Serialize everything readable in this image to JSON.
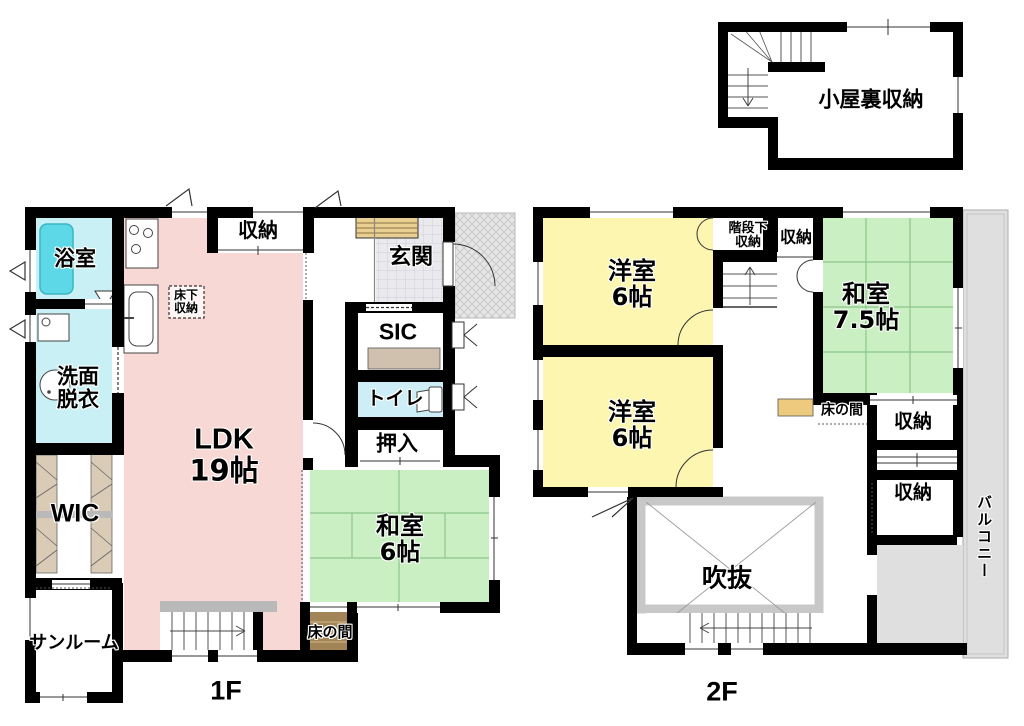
{
  "floor1": {
    "name": "1F",
    "rooms": {
      "bath": "浴室",
      "washroom_line1": "洗面",
      "washroom_line2": "脱衣",
      "wic": "WIC",
      "sunroom": "サンルーム",
      "ldk_line1": "LDK",
      "ldk_line2": "19帖",
      "storage_top": "収納",
      "underfloor_line1": "床下",
      "underfloor_line2": "収納",
      "genkan": "玄関",
      "sic": "SIC",
      "toilet": "トイレ",
      "oshiire": "押入",
      "washitsu_line1": "和室",
      "washitsu_line2": "6帖",
      "tokonoma": "床の間"
    }
  },
  "floor2": {
    "name": "2F",
    "rooms": {
      "yoshitsu1_line1": "洋室",
      "yoshitsu1_line2": "6帖",
      "yoshitsu2_line1": "洋室",
      "yoshitsu2_line2": "6帖",
      "under_stair_line1": "階段下",
      "under_stair_line2": "収納",
      "storage_a": "収納",
      "washitsu_line1": "和室",
      "washitsu_line2": "7.5帖",
      "tokonoma": "床の間",
      "storage_b": "収納",
      "storage_c": "収納",
      "void": "吹抜",
      "balcony": "バルコニー"
    }
  },
  "attic": {
    "storage": "小屋裏収納"
  },
  "colors": {
    "wall": "#000000",
    "ldk_pink": "#f8d8d5",
    "western_room_yellow": "#fcf6b0",
    "tatami_green": "#c9efc2",
    "tatami_line": "#8fc58b",
    "bath_cyan": "#c9f1f5",
    "tub_cyan": "#5cd8e6",
    "toilet_blue": "#cdeef7",
    "genkan_tile": "#eaeaee",
    "porch_gray": "#e6e6e6",
    "balcony_gray": "#dfdfdf",
    "stair_landing_gray": "#b9b9b9",
    "void_frame_gray": "#c8c8c8",
    "shoe_cabinet_tan": "#e9cf92",
    "sic_cabinet_tan": "#cfc1ad",
    "wic_shelf_tan": "#d9cbb5",
    "tokonoma_brown": "#a28456",
    "tokonoma_shelf_tan": "#edca7d"
  }
}
